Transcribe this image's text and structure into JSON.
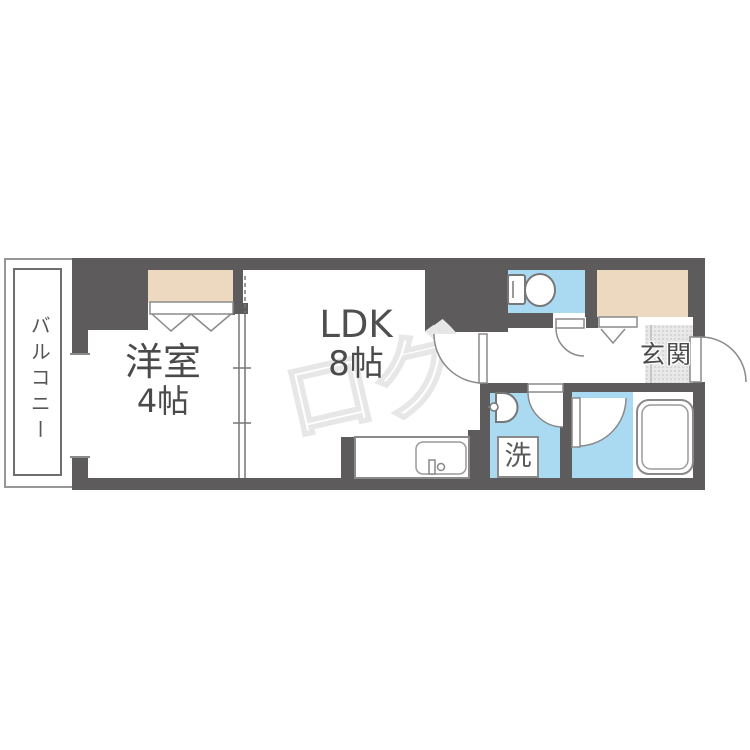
{
  "document": {
    "type": "apartment-floor-plan"
  },
  "labels": {
    "balcony": "バルコニー",
    "western_room_name": "洋室",
    "western_room_size": "4帖",
    "ldk_name": "LDK",
    "ldk_size": "8帖",
    "entrance": "玄関",
    "washing_machine": "洗"
  },
  "watermark": {
    "text": "ログ"
  },
  "colors": {
    "wall": "#5d5b5b",
    "wet_area_blue": "#aadaf2",
    "closet_beige": "#ecd9c0",
    "entrance_gray": "#e8e8e8",
    "fixture_outline_gray": "#8a8a8a",
    "label_gray": "#4a4a4a",
    "watermark_gray": "#e7e7e7"
  },
  "fixtures": [
    "toilet",
    "bathtub",
    "washbasin",
    "kitchen-sink",
    "washing-machine-space",
    "entry-door",
    "ldk-door",
    "toilet-door",
    "washroom-door",
    "bathroom-door",
    "sliding-door",
    "folding-closet-door",
    "window"
  ]
}
